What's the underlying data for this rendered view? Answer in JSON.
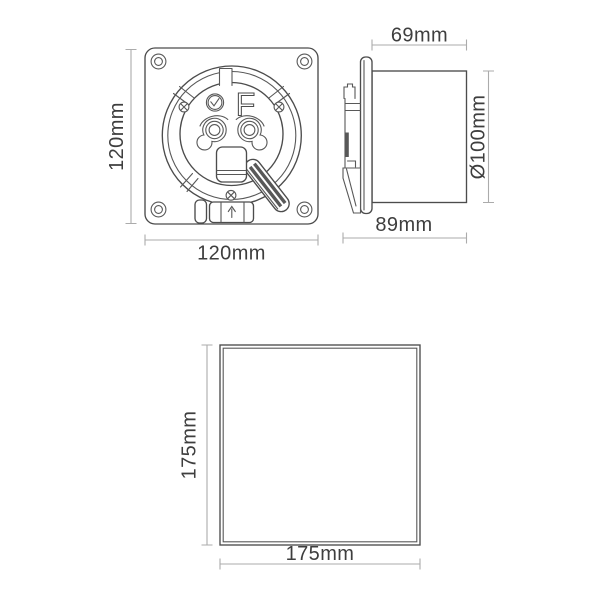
{
  "diagram": {
    "description": "Extractor fan technical dimension drawing with three views",
    "back_view": {
      "height_label": "120mm",
      "width_label": "120mm",
      "marking_letter": "F"
    },
    "side_view": {
      "duct_length_label": "69mm",
      "duct_diameter_label": "Ø100mm",
      "overall_depth_label": "89mm"
    },
    "front_panel_view": {
      "height_label": "175mm",
      "width_label": "175mm"
    }
  },
  "colors": {
    "background": "#ffffff",
    "line": "#4c4c4c",
    "line_secondary": "#585858",
    "dimension_line": "#ababab",
    "label_text": "#3e3e3e"
  }
}
